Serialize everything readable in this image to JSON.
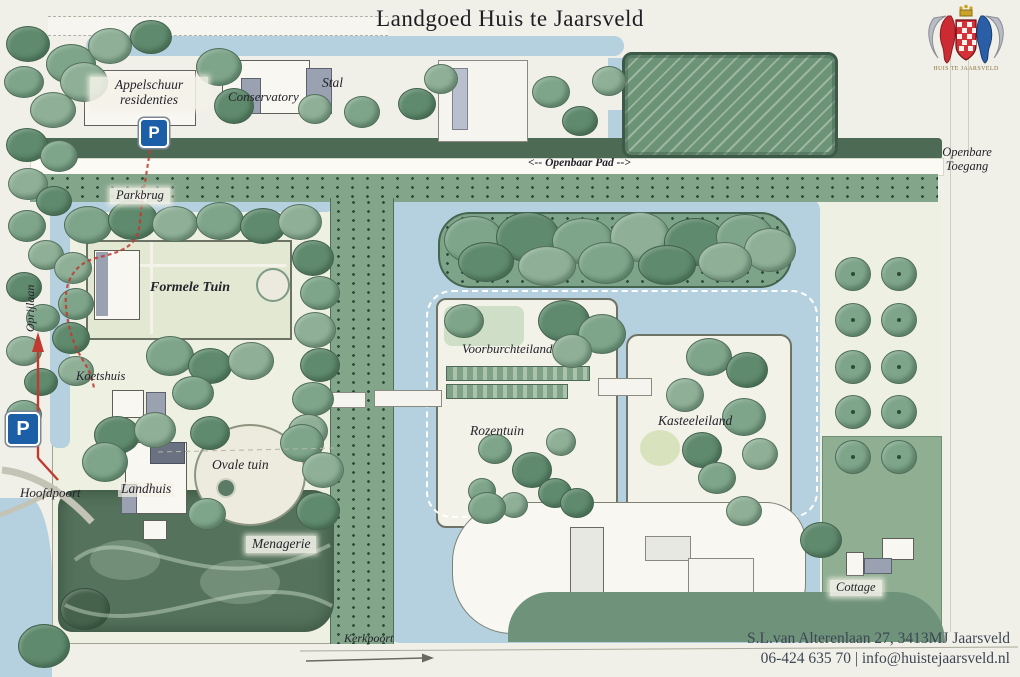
{
  "header": {
    "title": "Landgoed Huis te Jaarsveld"
  },
  "crest": {
    "caption": "HUIS TE JAARSVELD"
  },
  "map_labels": {
    "appelschuur_line1": "Appelschuur",
    "appelschuur_line2": "residenties",
    "conservatory": "Conservatory",
    "stal": "Stal",
    "openbaar_pad": "<-- Openbaar Pad -->",
    "openbare_toegang": "Openbare\nToegang",
    "parkbrug": "Parkbrug",
    "oprijlaan": "Oprijlaan",
    "formele_tuin": "Formele Tuin",
    "koetshuis": "Koetshuis",
    "hoofdpoort": "Hoofdpoort",
    "landhuis": "Landhuis",
    "ovale_tuin": "Ovale tuin",
    "menagerie": "Menagerie",
    "voorburchteiland": "Voorburchteiland",
    "rozentuin": "Rozentuin",
    "kasteeleiland": "Kasteeleiland",
    "cottage": "Cottage",
    "kerkpoort": "Kerkpoort",
    "parking_symbol": "P"
  },
  "footer": {
    "address": "S.L.van Alterenlaan 27, 3413MJ Jaarsveld",
    "contact": "06-424 635 70 | info@huistejaarsveld.nl"
  },
  "colors": {
    "parchment": "#f1f0e8",
    "water": "#b5d0de",
    "green_medium": "#7ea58a",
    "green_dark": "#46624d",
    "green_pale": "#e2e8d2",
    "roof_gray": "#9aa1b0",
    "parking_blue": "#1c5fa6",
    "route_red": "#bf3b2f",
    "ink": "#23232b",
    "crest_red": "#cc2b33",
    "crest_blue": "#2a5fa8",
    "crest_gold": "#c9a227"
  }
}
